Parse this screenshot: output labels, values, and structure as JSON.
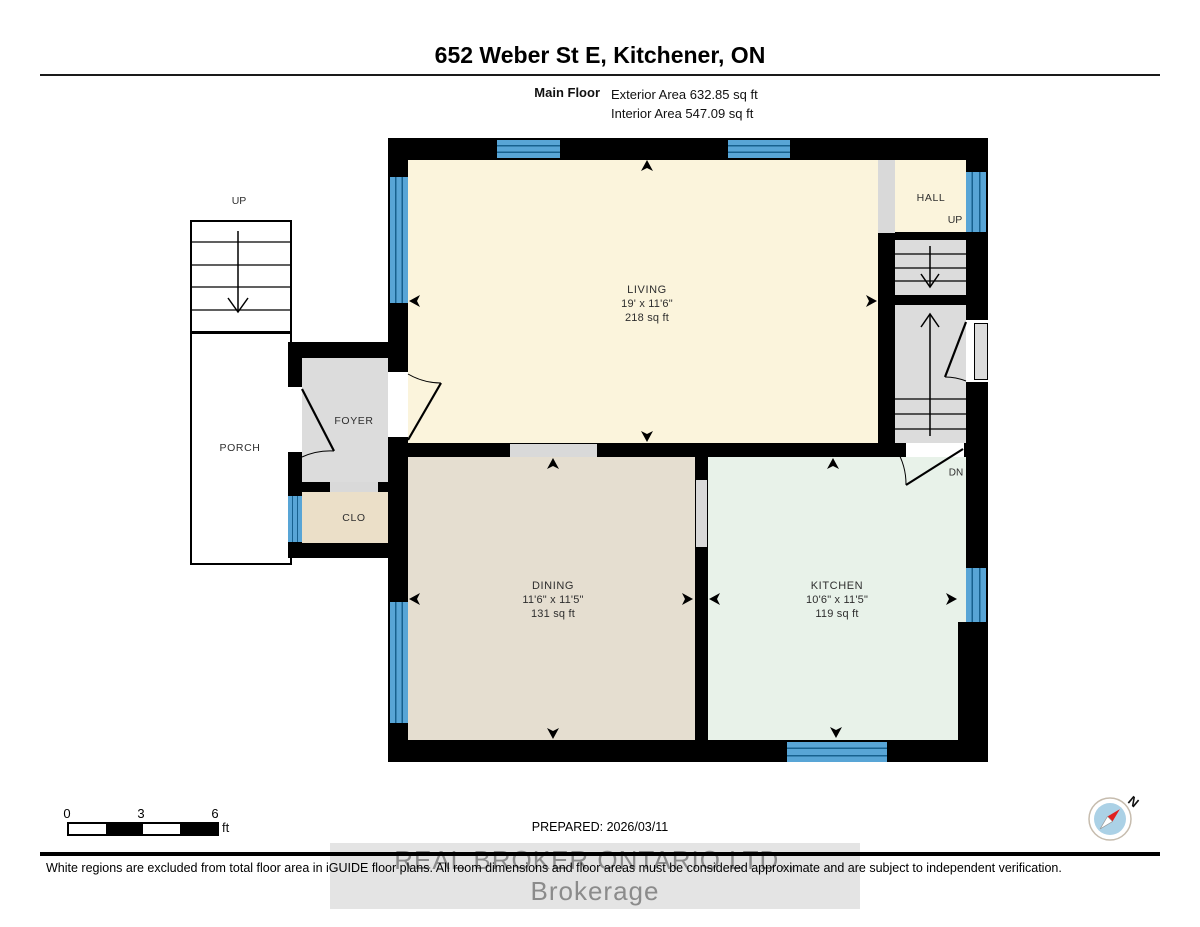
{
  "header": {
    "address": "652 Weber St E, Kitchener, ON",
    "floor_label": "Main Floor",
    "exterior_area": "Exterior Area 632.85 sq ft",
    "interior_area": "Interior Area 547.09 sq ft"
  },
  "rooms": {
    "living": {
      "name": "LIVING",
      "dims": "19' x 11'6\"",
      "area": "218 sq ft"
    },
    "dining": {
      "name": "DINING",
      "dims": "11'6\" x 11'5\"",
      "area": "131 sq ft"
    },
    "kitchen": {
      "name": "KITCHEN",
      "dims": "10'6\" x 11'5\"",
      "area": "119 sq ft"
    },
    "foyer": {
      "name": "FOYER"
    },
    "closet": {
      "name": "CLO"
    },
    "porch": {
      "name": "PORCH"
    },
    "hall": {
      "name": "HALL",
      "up": "UP"
    },
    "exterior_stairs": {
      "up": "UP"
    },
    "interior_stairs": {
      "dn": "DN"
    }
  },
  "footer": {
    "scale": {
      "t0": "0",
      "t3": "3",
      "t6": "6",
      "unit": "ft"
    },
    "prepared": "PREPARED: 2026/03/11",
    "watermark": "REAL BROKER ONTARIO LTD., Brokerage",
    "disclaimer": "White regions are excluded from total floor area in iGUIDE floor plans. All room dimensions and floor areas must be considered approximate and are subject to independent verification.",
    "compass_n": "N"
  },
  "colors": {
    "wall": "#000000",
    "living_fill": "#FBF4DC",
    "dining_fill": "#E5DED0",
    "kitchen_fill": "#E8F2E9",
    "gray_fill": "#DCDCDC",
    "closet_fill": "#EBDFC8",
    "window_blue": "#58A5D6",
    "opening_gray": "#D9D9D9",
    "compass_blue": "#ABD1E6",
    "compass_red": "#E02020"
  }
}
